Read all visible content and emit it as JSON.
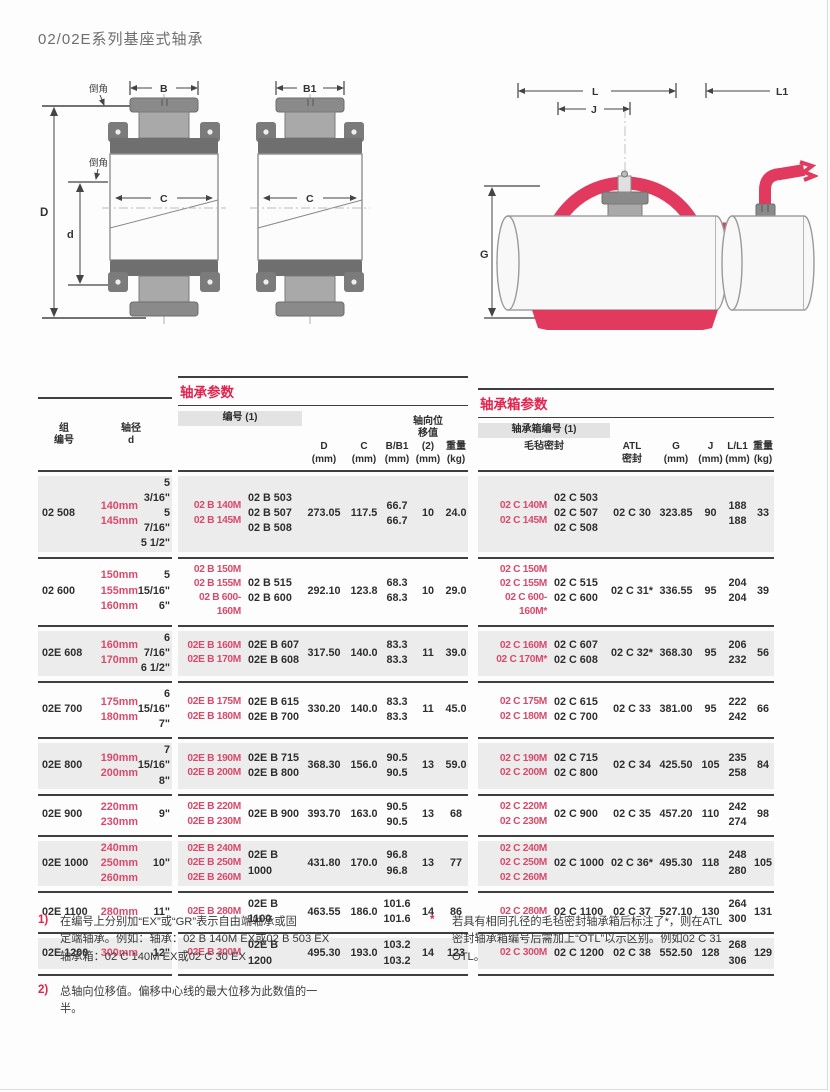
{
  "page": {
    "title": "02/02E系列基座式轴承"
  },
  "colors": {
    "accent_red": "#e2244f",
    "designation_red": "#d84a6b",
    "row_shade": "#ececec",
    "header_band": "#e3e3e3",
    "rule": "#3f3f3f",
    "diagram_red": "#e23a5e",
    "metal_gray": "#7d7d7d"
  },
  "diagrams": {
    "labels": {
      "chamfer": "倒角",
      "b": "B",
      "b1": "B1",
      "c": "C",
      "d_outer": "D",
      "d_inner": "d",
      "l": "L",
      "j": "J",
      "l1": "L1",
      "g": "G"
    }
  },
  "table": {
    "left_header": {
      "group": "组\n编号",
      "shaft": "轴径\nd"
    },
    "units": {
      "mm": "(mm)",
      "kg": "(kg)"
    },
    "bearing_section": {
      "title": "轴承参数",
      "designation_header": "编号 (1)",
      "axial_header_top": "轴向位",
      "axial_header_bottom": "移值 (2)",
      "col_d": "D",
      "col_c": "C",
      "col_b": "B/B1",
      "col_weight": "重量"
    },
    "housing_section": {
      "title": "轴承箱参数",
      "designation_header": "轴承箱编号 (1)",
      "felt_seal_label": "毛毡密封",
      "atl_label_top": "ATL",
      "atl_label_bottom": "密封",
      "col_g": "G",
      "col_j": "J",
      "col_l": "L/L1",
      "col_weight": "重量"
    },
    "rows": [
      {
        "group": "02 508",
        "mm": [
          "140mm",
          "145mm"
        ],
        "inch": [
          "5 3/16\"",
          "5 7/16\"",
          "5 1/2\""
        ],
        "bearing_red": [
          "02 B 140M",
          "02 B 145M"
        ],
        "bearing_black": [
          "02 B 503",
          "02 B 507",
          "02 B 508"
        ],
        "D": "273.05",
        "C": "117.5",
        "B": [
          "66.7",
          "66.7"
        ],
        "axial": "10",
        "wt": "24.0",
        "housing_red": [
          "02 C 140M",
          "02 C 145M"
        ],
        "housing_black": [
          "02 C 503",
          "02 C 507",
          "02 C 508"
        ],
        "atl": "02 C 30",
        "G": "323.85",
        "J": "90",
        "L": [
          "188",
          "188"
        ],
        "hwt": "33"
      },
      {
        "group": "02 600",
        "mm": [
          "150mm",
          "155mm",
          "160mm"
        ],
        "inch": [
          "5",
          "15/16\"",
          "6\""
        ],
        "bearing_red": [
          "02 B 150M",
          "02 B 155M",
          "02 B 600-160M"
        ],
        "bearing_black": [
          "02 B 515",
          "02 B 600"
        ],
        "D": "292.10",
        "C": "123.8",
        "B": [
          "68.3",
          "68.3"
        ],
        "axial": "10",
        "wt": "29.0",
        "housing_red": [
          "02 C 150M",
          "02 C 155M",
          "02 C 600-160M*"
        ],
        "housing_black": [
          "02 C 515",
          "02 C 600"
        ],
        "atl": "02 C 31*",
        "G": "336.55",
        "J": "95",
        "L": [
          "204",
          "204"
        ],
        "hwt": "39"
      },
      {
        "group": "02E 608",
        "mm": [
          "160mm",
          "170mm"
        ],
        "inch": [
          "6 7/16\"",
          "6 1/2\""
        ],
        "bearing_red": [
          "02E B 160M",
          "02E B 170M"
        ],
        "bearing_black": [
          "02E B 607",
          "02E B 608"
        ],
        "D": "317.50",
        "C": "140.0",
        "B": [
          "83.3",
          "83.3"
        ],
        "axial": "11",
        "wt": "39.0",
        "housing_red": [
          "02 C 160M",
          "02 C 170M*"
        ],
        "housing_black": [
          "02 C 607",
          "02 C 608"
        ],
        "atl": "02 C 32*",
        "G": "368.30",
        "J": "95",
        "L": [
          "206",
          "232"
        ],
        "hwt": "56"
      },
      {
        "group": "02E 700",
        "mm": [
          "175mm",
          "180mm"
        ],
        "inch": [
          "6 15/16\"",
          "7\""
        ],
        "bearing_red": [
          "02E B 175M",
          "02E B 180M"
        ],
        "bearing_black": [
          "02E B 615",
          "02E B 700"
        ],
        "D": "330.20",
        "C": "140.0",
        "B": [
          "83.3",
          "83.3"
        ],
        "axial": "11",
        "wt": "45.0",
        "housing_red": [
          "02 C 175M",
          "02 C 180M"
        ],
        "housing_black": [
          "02 C 615",
          "02 C 700"
        ],
        "atl": "02 C 33",
        "G": "381.00",
        "J": "95",
        "L": [
          "222",
          "242"
        ],
        "hwt": "66"
      },
      {
        "group": "02E 800",
        "mm": [
          "190mm",
          "200mm"
        ],
        "inch": [
          "7 15/16\"",
          "8\""
        ],
        "bearing_red": [
          "02E B 190M",
          "02E B 200M"
        ],
        "bearing_black": [
          "02E B 715",
          "02E B 800"
        ],
        "D": "368.30",
        "C": "156.0",
        "B": [
          "90.5",
          "90.5"
        ],
        "axial": "13",
        "wt": "59.0",
        "housing_red": [
          "02 C 190M",
          "02 C 200M"
        ],
        "housing_black": [
          "02 C 715",
          "02 C 800"
        ],
        "atl": "02 C 34",
        "G": "425.50",
        "J": "105",
        "L": [
          "235",
          "258"
        ],
        "hwt": "84"
      },
      {
        "group": "02E 900",
        "mm": [
          "220mm",
          "230mm"
        ],
        "inch": [
          "9\""
        ],
        "bearing_red": [
          "02E B 220M",
          "02E B 230M"
        ],
        "bearing_black": [
          "02E B 900"
        ],
        "D": "393.70",
        "C": "163.0",
        "B": [
          "90.5",
          "90.5"
        ],
        "axial": "13",
        "wt": "68",
        "housing_red": [
          "02 C 220M",
          "02 C 230M"
        ],
        "housing_black": [
          "02 C 900"
        ],
        "atl": "02 C 35",
        "G": "457.20",
        "J": "110",
        "L": [
          "242",
          "274"
        ],
        "hwt": "98"
      },
      {
        "group": "02E 1000",
        "mm": [
          "240mm",
          "250mm",
          "260mm"
        ],
        "inch": [
          "10\""
        ],
        "bearing_red": [
          "02E B 240M",
          "02E B 250M",
          "02E B 260M"
        ],
        "bearing_black": [
          "02E B",
          "1000"
        ],
        "D": "431.80",
        "C": "170.0",
        "B": [
          "96.8",
          "96.8"
        ],
        "axial": "13",
        "wt": "77",
        "housing_red": [
          "02 C 240M",
          "02 C 250M",
          "02 C 260M"
        ],
        "housing_black": [
          "02 C 1000"
        ],
        "atl": "02 C 36*",
        "G": "495.30",
        "J": "118",
        "L": [
          "248",
          "280"
        ],
        "hwt": "105"
      },
      {
        "group": "02E 1100",
        "mm": [
          "280mm"
        ],
        "inch": [
          "11\""
        ],
        "bearing_red": [
          "02E B 280M"
        ],
        "bearing_black": [
          "02E B",
          "1100"
        ],
        "D": "463.55",
        "C": "186.0",
        "B": [
          "101.6",
          "101.6"
        ],
        "axial": "14",
        "wt": "86",
        "housing_red": [
          "02 C 280M"
        ],
        "housing_black": [
          "02 C 1100"
        ],
        "atl": "02 C 37",
        "G": "527.10",
        "J": "130",
        "L": [
          "264",
          "300"
        ],
        "hwt": "131"
      },
      {
        "group": "02E 1200",
        "mm": [
          "300mm"
        ],
        "inch": [
          "12\""
        ],
        "bearing_red": [
          "02E B 300M"
        ],
        "bearing_black": [
          "02E B",
          "1200"
        ],
        "D": "495.30",
        "C": "193.0",
        "B": [
          "103.2",
          "103.2"
        ],
        "axial": "14",
        "wt": "123",
        "housing_red": [
          "02 C 300M"
        ],
        "housing_black": [
          "02 C 1200"
        ],
        "atl": "02 C 38",
        "G": "552.50",
        "J": "128",
        "L": [
          "268",
          "306"
        ],
        "hwt": "129"
      }
    ]
  },
  "footnotes": [
    {
      "marker": "1)",
      "text": "在编号上分别加“EX”或“GR”表示自由端轴承或固\n定端轴承。例如：轴承：02 B 140M EX或02 B 503 EX\n轴承箱：02 C 140M EX或02 C 30 EX"
    },
    {
      "marker": "2)",
      "text": "总轴向位移值。偏移中心线的最大位移为此数值的一\n半。"
    },
    {
      "marker": "*",
      "text": "若具有相同孔径的毛毡密封轴承箱后标注了*，则在ATL\n密封轴承箱编号后需加上“OTL”以示区别。例如02 C 31\nOTL。"
    }
  ]
}
